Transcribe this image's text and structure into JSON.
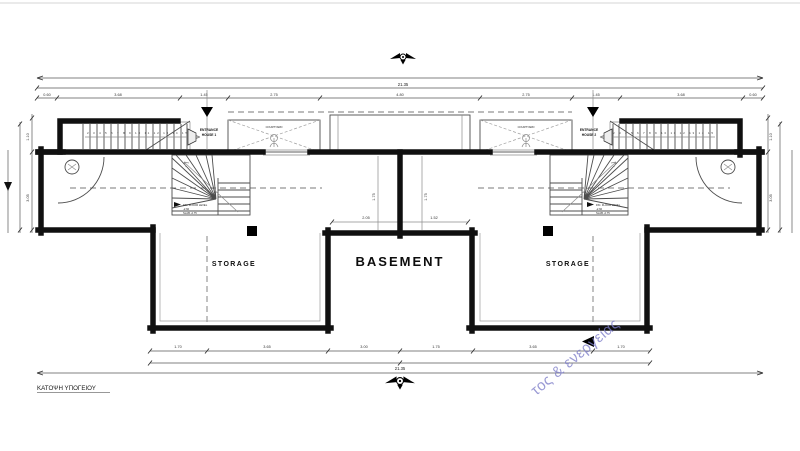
{
  "drawing": {
    "caption": "ΚΑΤΟΨΗ ΥΠΟΓΕΙΟΥ",
    "rooms": {
      "basement": "BASEMENT",
      "storage_left": "STORAGE",
      "storage_right": "STORAGE"
    },
    "entrances": {
      "house1_line1": "ENTRANCE",
      "house1_line2": "HOUSE 1",
      "house2_line1": "ENTRANCE",
      "house2_line2": "HOUSE 2"
    },
    "courtyards": {
      "left": "COURTYARD",
      "right": "COURTYARD"
    },
    "levels": {
      "left": [
        "FIN. FLOOR LEVEL",
        "-2.60",
        "SLAB -2.75"
      ],
      "right": [
        "FIN. FLOOR LEVEL",
        "-2.60",
        "SLAB -2.75"
      ]
    },
    "stairs": {
      "left_numbers": "2 3 4 5 6 7 8 9 10 11 12 13 14 15",
      "right_numbers": "2 3 4 5 6 7 8 9 10 11 12 13 14 15"
    },
    "dims": {
      "top_total": "21.35",
      "top_row3": [
        "0.60",
        "3.68",
        "1.45",
        "2.75",
        "4.80",
        "2.75",
        "1.45",
        "3.68",
        "0.60"
      ],
      "center_upper": [
        "2.05",
        "1.52"
      ],
      "center_vert": [
        "1.75",
        "1.75"
      ],
      "left_vert": [
        "1.10",
        "3.05"
      ],
      "right_vert": [
        "1.10",
        "3.05"
      ],
      "bottom_row1": [
        "1.70",
        "3.65",
        "3.00",
        "1.75",
        "3.65",
        "1.70"
      ],
      "bottom_total": "21.35"
    }
  },
  "watermark": {
    "text": "τος & ενεργείας",
    "color": "#7d7dc8"
  },
  "colors": {
    "wall": "#101010",
    "background": "#ffffff"
  }
}
